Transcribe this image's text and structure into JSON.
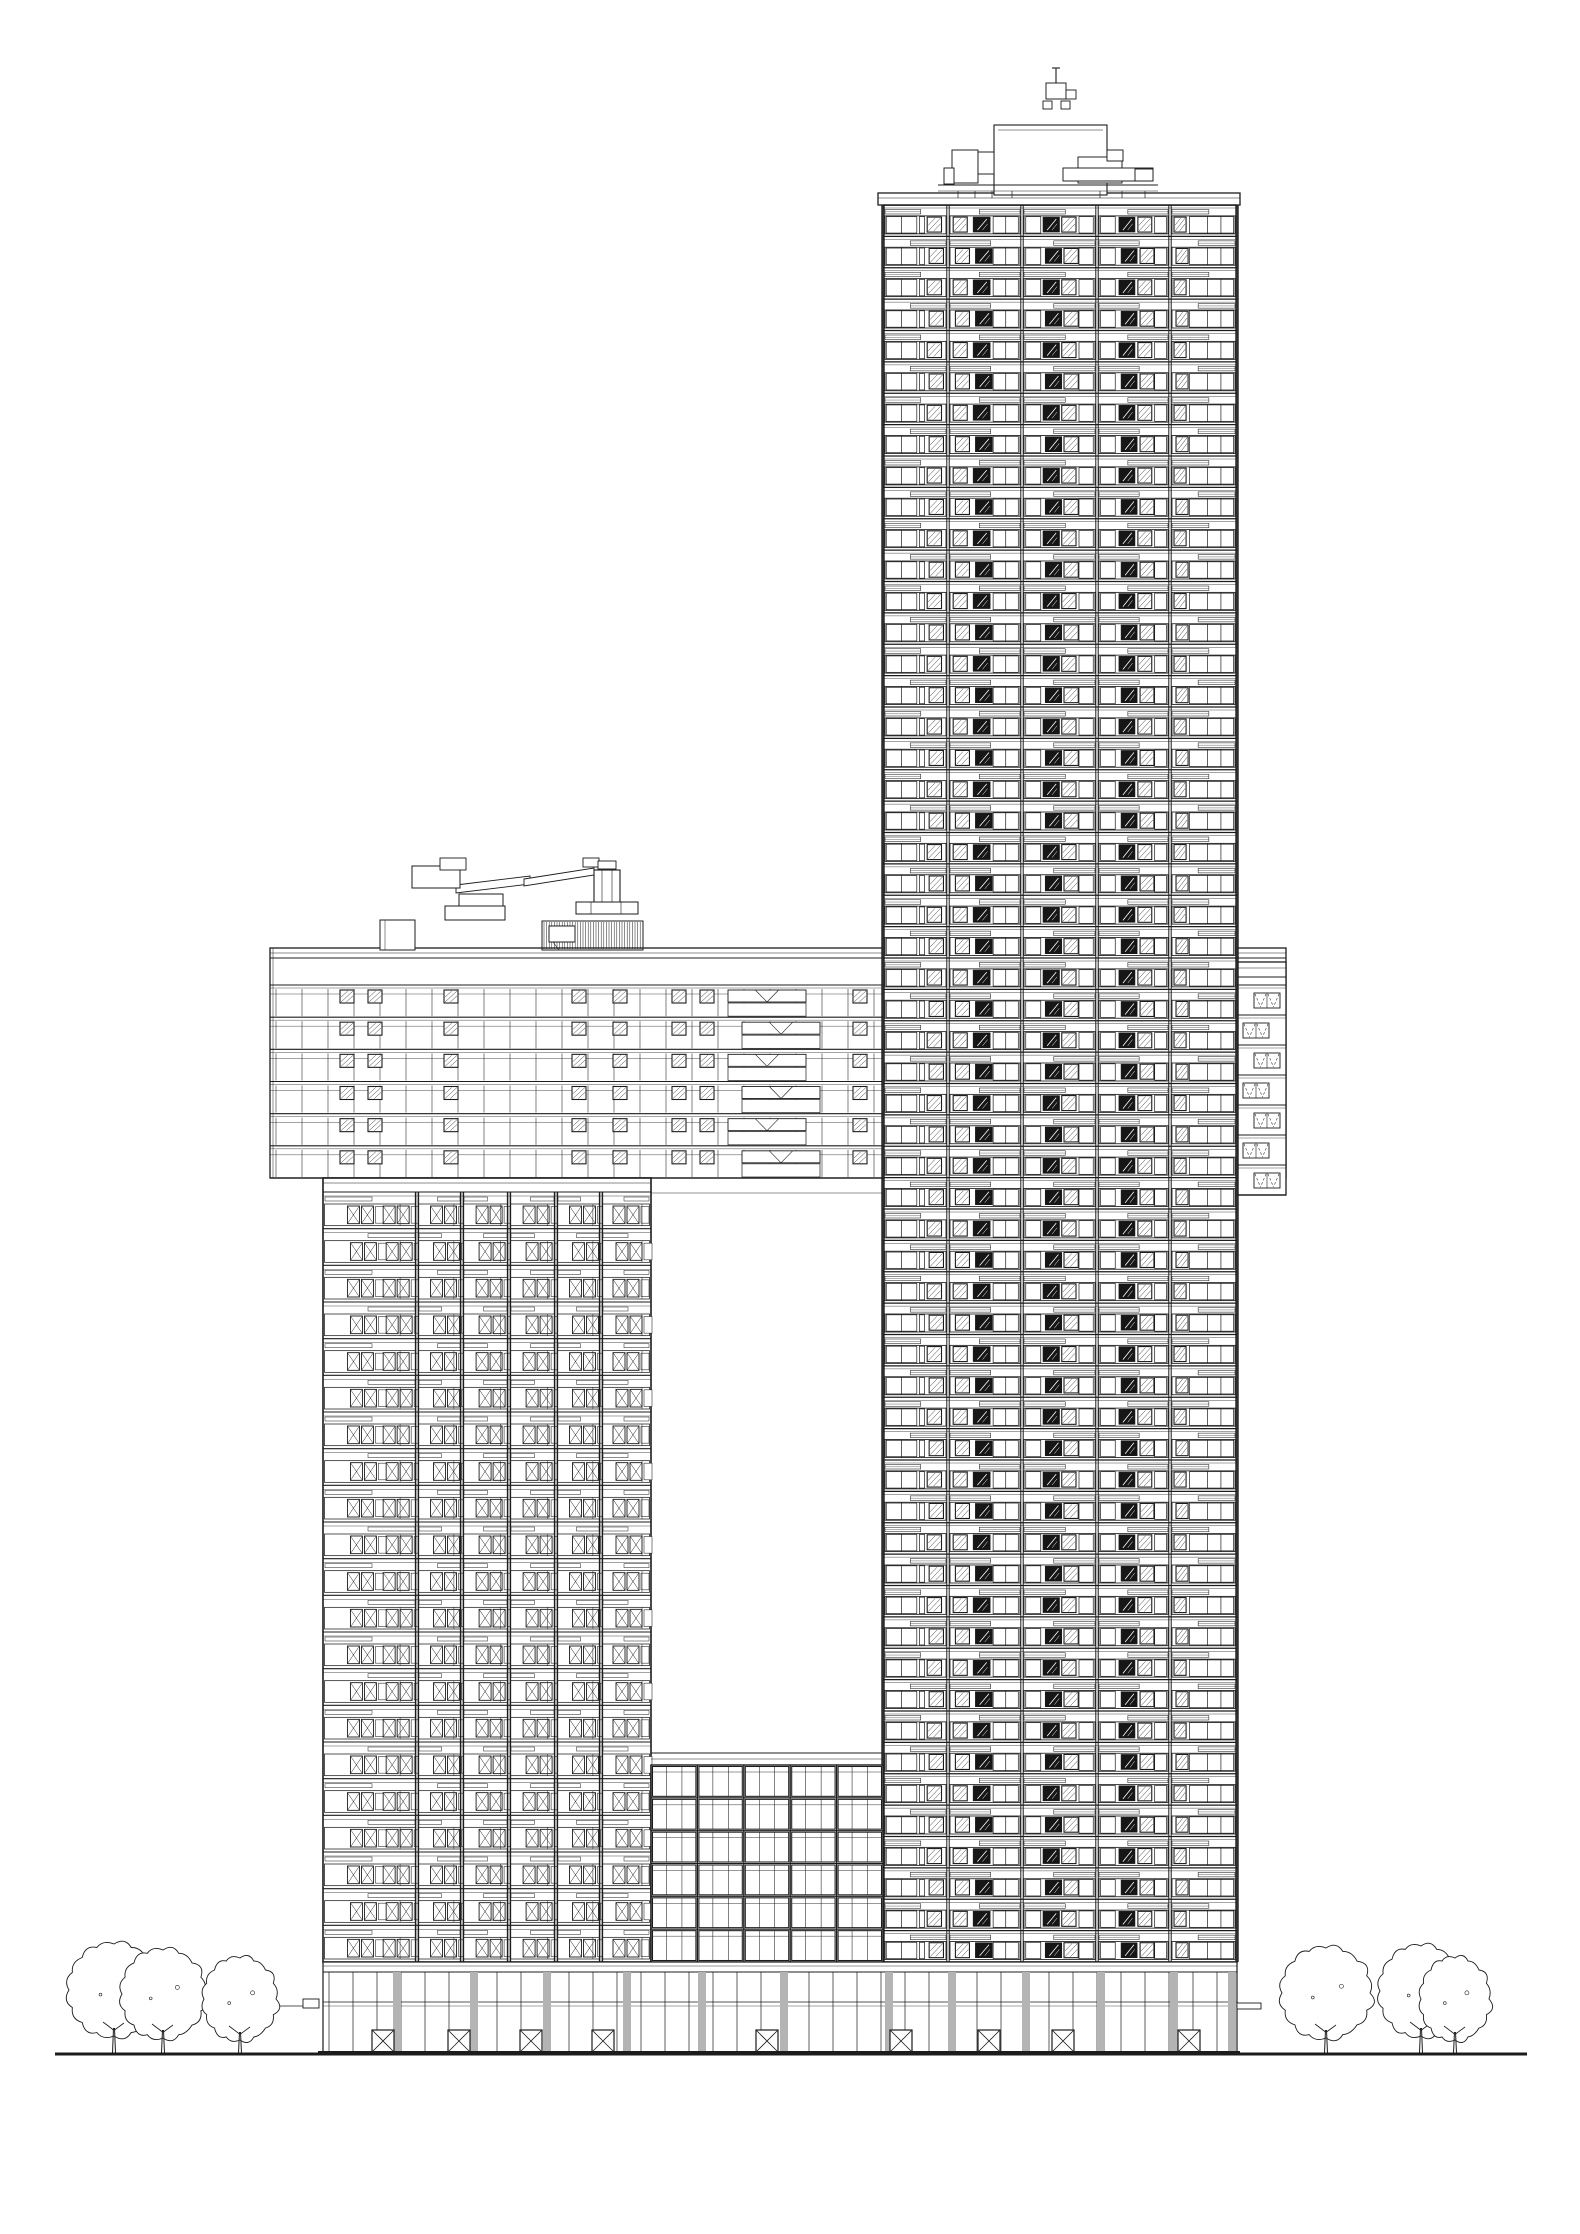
{
  "meta": {
    "title": "High-rise complex elevation - architectural line drawing",
    "drawing_type": "building elevation",
    "background": "#ffffff",
    "line_color": "#1c1c1c",
    "faint_color": "#6f6f6f",
    "accent_gray": "#b4b4b4",
    "window_dark": "#161616",
    "symbols": {
      "x_window": "casement-window-symbol",
      "hatch_window": "vent-window-symbol",
      "dark_window": "recessed-dark-window",
      "dashed_v_window": "awning-window-symbol",
      "x_door": "entrance-door-symbol",
      "louvre": "mechanical-louvre",
      "tree": "deciduous-tree-symbol"
    }
  },
  "canvas": {
    "width": 1580,
    "height": 2234
  },
  "site": {
    "ground_line": {
      "y": 2054,
      "x1": 55,
      "x2": 1527,
      "thickness": 3
    },
    "base_line": {
      "y": 2052,
      "x1": 318,
      "x2": 1240,
      "thickness": 2
    },
    "canopy_left": {
      "x": 303,
      "y": 1999,
      "width": 16,
      "height": 9,
      "tail_x": 213
    },
    "canopy_right": {
      "x": 1237,
      "y": 2003,
      "width": 24,
      "height": 6
    }
  },
  "buildings": {
    "tall_tower": {
      "x": 883,
      "width": 354,
      "top": 205,
      "bottom": 1962,
      "floors": 56,
      "parapet": {
        "x": 878,
        "y": 193,
        "width": 362,
        "height": 12
      },
      "bay_offsets": [
        0,
        65,
        139,
        214,
        287,
        354
      ],
      "bay_windows": [
        [
          [
            "w",
            0.05,
            0.52
          ],
          [
            "m",
            0.285
          ],
          [
            "w",
            0.56,
            0.64
          ],
          [
            "h",
            0.68,
            0.9
          ]
        ],
        [
          [
            "h",
            0.07,
            0.26
          ],
          [
            "d",
            0.34,
            0.57
          ],
          [
            "w",
            0.61,
            0.95
          ],
          [
            "m",
            0.78
          ]
        ],
        [
          [
            "w",
            0.05,
            0.25
          ],
          [
            "d",
            0.28,
            0.5
          ],
          [
            "h",
            0.53,
            0.72
          ],
          [
            "w",
            0.76,
            0.95
          ]
        ],
        [
          [
            "w",
            0.05,
            0.25
          ],
          [
            "d",
            0.3,
            0.52
          ],
          [
            "h",
            0.56,
            0.75
          ],
          [
            "w",
            0.79,
            0.95
          ]
        ],
        [
          [
            "h",
            0.06,
            0.24
          ],
          [
            "w",
            0.29,
            0.95
          ],
          [
            "m",
            0.56
          ],
          [
            "m",
            0.76
          ]
        ]
      ]
    },
    "bridge": {
      "x": 270,
      "x2": 1286,
      "parapet_top": 948,
      "band_bottom": 985,
      "floors_bottom": 1178,
      "floors": 6,
      "mullion_step": 26,
      "hatch_x": [
        340,
        368,
        444,
        572,
        613,
        672,
        700,
        853
      ],
      "v_panel": {
        "x": 728,
        "width": 78
      },
      "soffit": {
        "y": 1193,
        "x1": 651,
        "x2": 883
      }
    },
    "left_tower": {
      "x": 323,
      "width": 328,
      "band_top": 1178,
      "floors_top": 1192,
      "bottom": 1962,
      "floors": 21,
      "bay_edges": [
        0,
        94,
        139,
        186,
        233,
        278,
        328
      ],
      "pair_fractions": [
        [
          0.26,
          0.64
        ],
        [
          0.3
        ],
        [
          0.3
        ],
        [
          0.3
        ],
        [
          0.3
        ],
        [
          0.24
        ]
      ]
    },
    "right_wing": {
      "x": 1237,
      "width": 49,
      "top": 962,
      "grid_top": 985,
      "bottom": 1195,
      "floors": 7
    },
    "podium": {
      "x": 651,
      "width": 232,
      "roof_y": 1753,
      "grid_top": 1765,
      "bottom": 1962,
      "rows": 6,
      "bays": 5,
      "subpanels": 3
    },
    "ground_floor": {
      "x": 323,
      "x2": 1237,
      "top": 1962,
      "band_y": 1972,
      "transom_y": 2002,
      "door_top": 2030,
      "bottom": 2052,
      "mullion_step": 24,
      "pilasters": [
        393,
        470,
        543,
        623,
        698,
        780,
        885,
        948,
        1022,
        1097,
        1170,
        1228
      ],
      "pilaster_width": 8,
      "doors": [
        372,
        448,
        520,
        592,
        756,
        890,
        978,
        1052,
        1178
      ],
      "door_width": 22
    }
  },
  "equipment": {
    "roof_plant": {
      "penthouse": {
        "x": 994,
        "y": 125,
        "width": 113,
        "height": 70
      },
      "boxes": [
        [
          952,
          150,
          26,
          33
        ],
        [
          978,
          152,
          16,
          22
        ],
        [
          1078,
          157,
          44,
          26
        ],
        [
          1107,
          150,
          16,
          11
        ],
        [
          1063,
          168,
          90,
          13
        ],
        [
          1135,
          169,
          18,
          12
        ],
        [
          944,
          168,
          10,
          16
        ]
      ],
      "deck": {
        "y": 185,
        "x1": 938,
        "x2": 1158
      },
      "legs": [
        958,
        975,
        992,
        1012,
        1100,
        1122,
        1145
      ],
      "davit": {
        "mast_x": 1056,
        "mast_top": 68,
        "box": [
          1046,
          83,
          20,
          16
        ],
        "arm": [
          1066,
          90,
          10,
          9
        ],
        "feet": [
          [
            1043,
            101,
            9,
            8
          ],
          [
            1061,
            101,
            9,
            8
          ]
        ]
      }
    },
    "bmu_crane": {
      "parapet_block": [
        380,
        920,
        35,
        30
      ],
      "pedestal": [
        445,
        906,
        60,
        14
      ],
      "turret": [
        459,
        894,
        44,
        12
      ],
      "cab": [
        440,
        858,
        26,
        12
      ],
      "counterweight": [
        412,
        866,
        48,
        22
      ],
      "boom1": [
        [
          456,
          885
        ],
        [
          530,
          876
        ],
        [
          530,
          884
        ],
        [
          456,
          893
        ]
      ],
      "boom2": [
        [
          524,
          879
        ],
        [
          594,
          868
        ],
        [
          594,
          875
        ],
        [
          524,
          886
        ]
      ],
      "jib_head": [
        [
          583,
          858,
          16,
          9
        ],
        [
          598,
          861,
          18,
          8
        ]
      ],
      "mast": [
        594,
        870,
        26,
        42
      ],
      "mast_base": [
        576,
        902,
        62,
        12
      ],
      "louvre": {
        "x": 542,
        "y": 921,
        "width": 101,
        "height": 29,
        "window": [
          549,
          926,
          26,
          16
        ]
      }
    }
  },
  "vegetation": {
    "left_trees": [
      {
        "cx": 114,
        "rx": 45,
        "top": 1944,
        "bottom": 2036
      },
      {
        "cx": 163,
        "rx": 41,
        "top": 1950,
        "bottom": 2038
      },
      {
        "cx": 240,
        "rx": 36,
        "top": 1958,
        "bottom": 2040
      }
    ],
    "right_trees": [
      {
        "cx": 1326,
        "rx": 44,
        "top": 1948,
        "bottom": 2038
      },
      {
        "cx": 1421,
        "rx": 41,
        "top": 1946,
        "bottom": 2036
      },
      {
        "cx": 1455,
        "rx": 34,
        "top": 1958,
        "bottom": 2040
      }
    ]
  }
}
